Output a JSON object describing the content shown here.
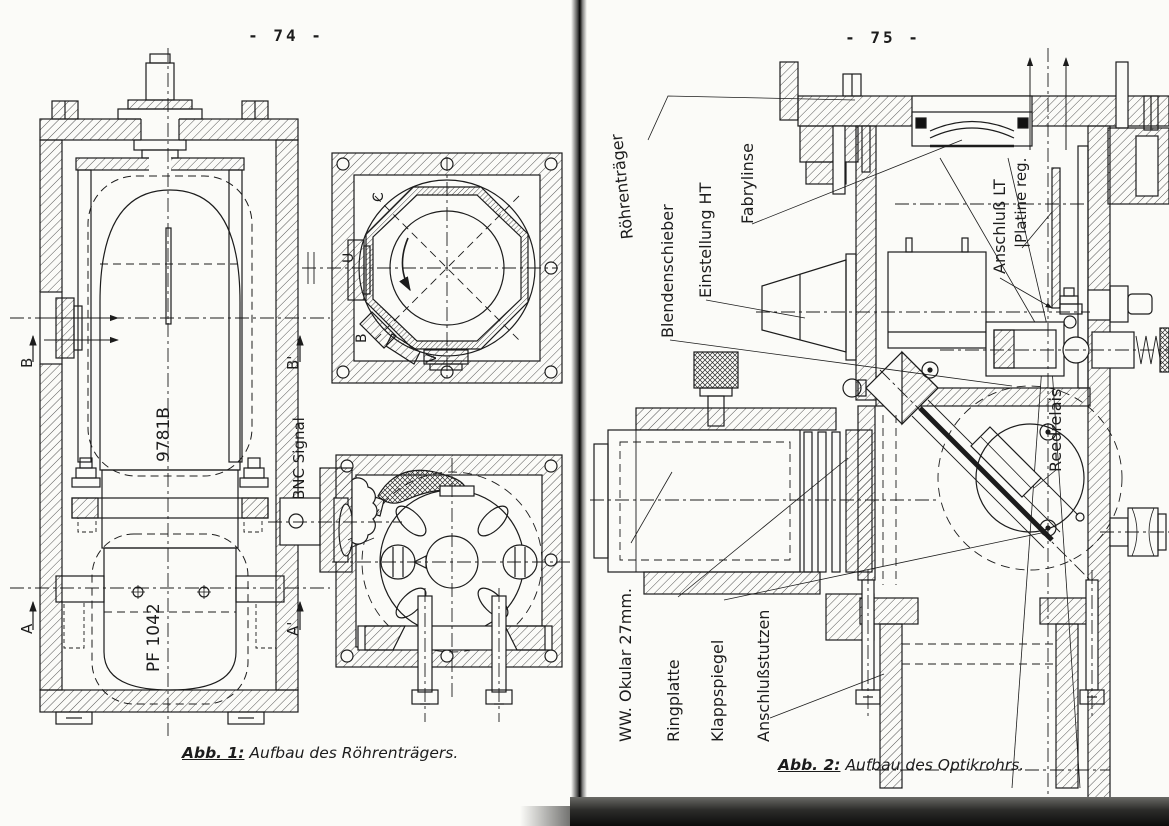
{
  "scan": {
    "left_page_number": "- 74 -",
    "right_page_number": "- 75 -"
  },
  "figure1": {
    "caption_label": "Abb. 1:",
    "caption_text": "Aufbau des Röhrenträgers.",
    "labels": {
      "section_b": "B",
      "section_b_prime": "B'",
      "section_a": "A",
      "section_a_prime": "A'",
      "tube_code": "9781B",
      "tube_model": "PF 1042",
      "bnc_signal": "BNC Signal",
      "oct_c": "C",
      "oct_u": "U",
      "oct_b": "B",
      "oct_v": "V"
    }
  },
  "figure2": {
    "caption_label": "Abb. 2:",
    "caption_text": "Aufbau des Optikrohrs.",
    "labels": {
      "roehrentraeger": "Röhrenträger",
      "blendenschieber": "Blendenschieber",
      "einstellung_ht": "Einstellung HT",
      "fabrylinse": "Fabrylinse",
      "anschluss_lt": "Anschluß LT",
      "platine_reg": "|Platine reg.",
      "reedrelais": "Reedrelais",
      "okular": "WW. Okular 27mm.",
      "ringplatte": "Ringplatte",
      "klappspiegel": "Klappspiegel",
      "anschlussstutzen": "Anschlußstutzen"
    }
  }
}
